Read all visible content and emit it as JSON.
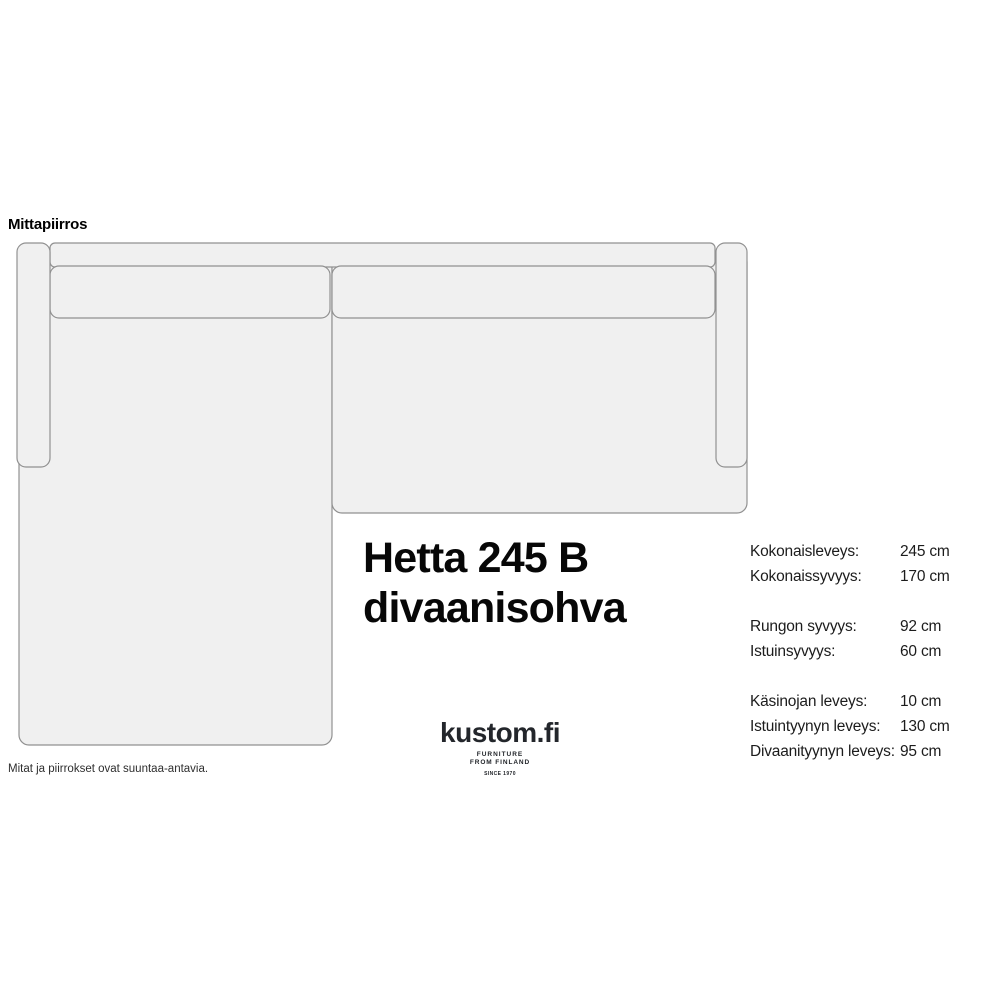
{
  "diagram": {
    "section_label": "Mittapiirros",
    "footnote": "Mitat ja piirrokset ovat suuntaa-antavia.",
    "fill": "#f0f0f0",
    "stroke": "#919191",
    "parts": [
      "divan-seat",
      "right-seat",
      "back-frame",
      "back-cushion-left",
      "back-cushion-right",
      "left-armrest",
      "right-armrest"
    ]
  },
  "product": {
    "title_line1": "Hetta 245 B",
    "title_line2": "divaanisohva"
  },
  "logo": {
    "brand": "kustom.fi",
    "tagline_line1": "FURNITURE",
    "tagline_line2": "FROM FINLAND",
    "since": "SINCE 1970"
  },
  "dimensions": {
    "groups": [
      {
        "rows": [
          {
            "label": "Kokonaisleveys:",
            "value": "245 cm"
          },
          {
            "label": "Kokonaissyvyys:",
            "value": "170 cm"
          }
        ]
      },
      {
        "rows": [
          {
            "label": "Rungon syvyys:",
            "value": "92 cm"
          },
          {
            "label": "Istuinsyvyys:",
            "value": "60 cm"
          }
        ]
      },
      {
        "rows": [
          {
            "label": "Käsinojan leveys:",
            "value": "10 cm"
          },
          {
            "label": "Istuintyynyn leveys:",
            "value": "130 cm"
          },
          {
            "label": "Divaanityynyn leveys:",
            "value": "95 cm"
          }
        ]
      }
    ]
  }
}
